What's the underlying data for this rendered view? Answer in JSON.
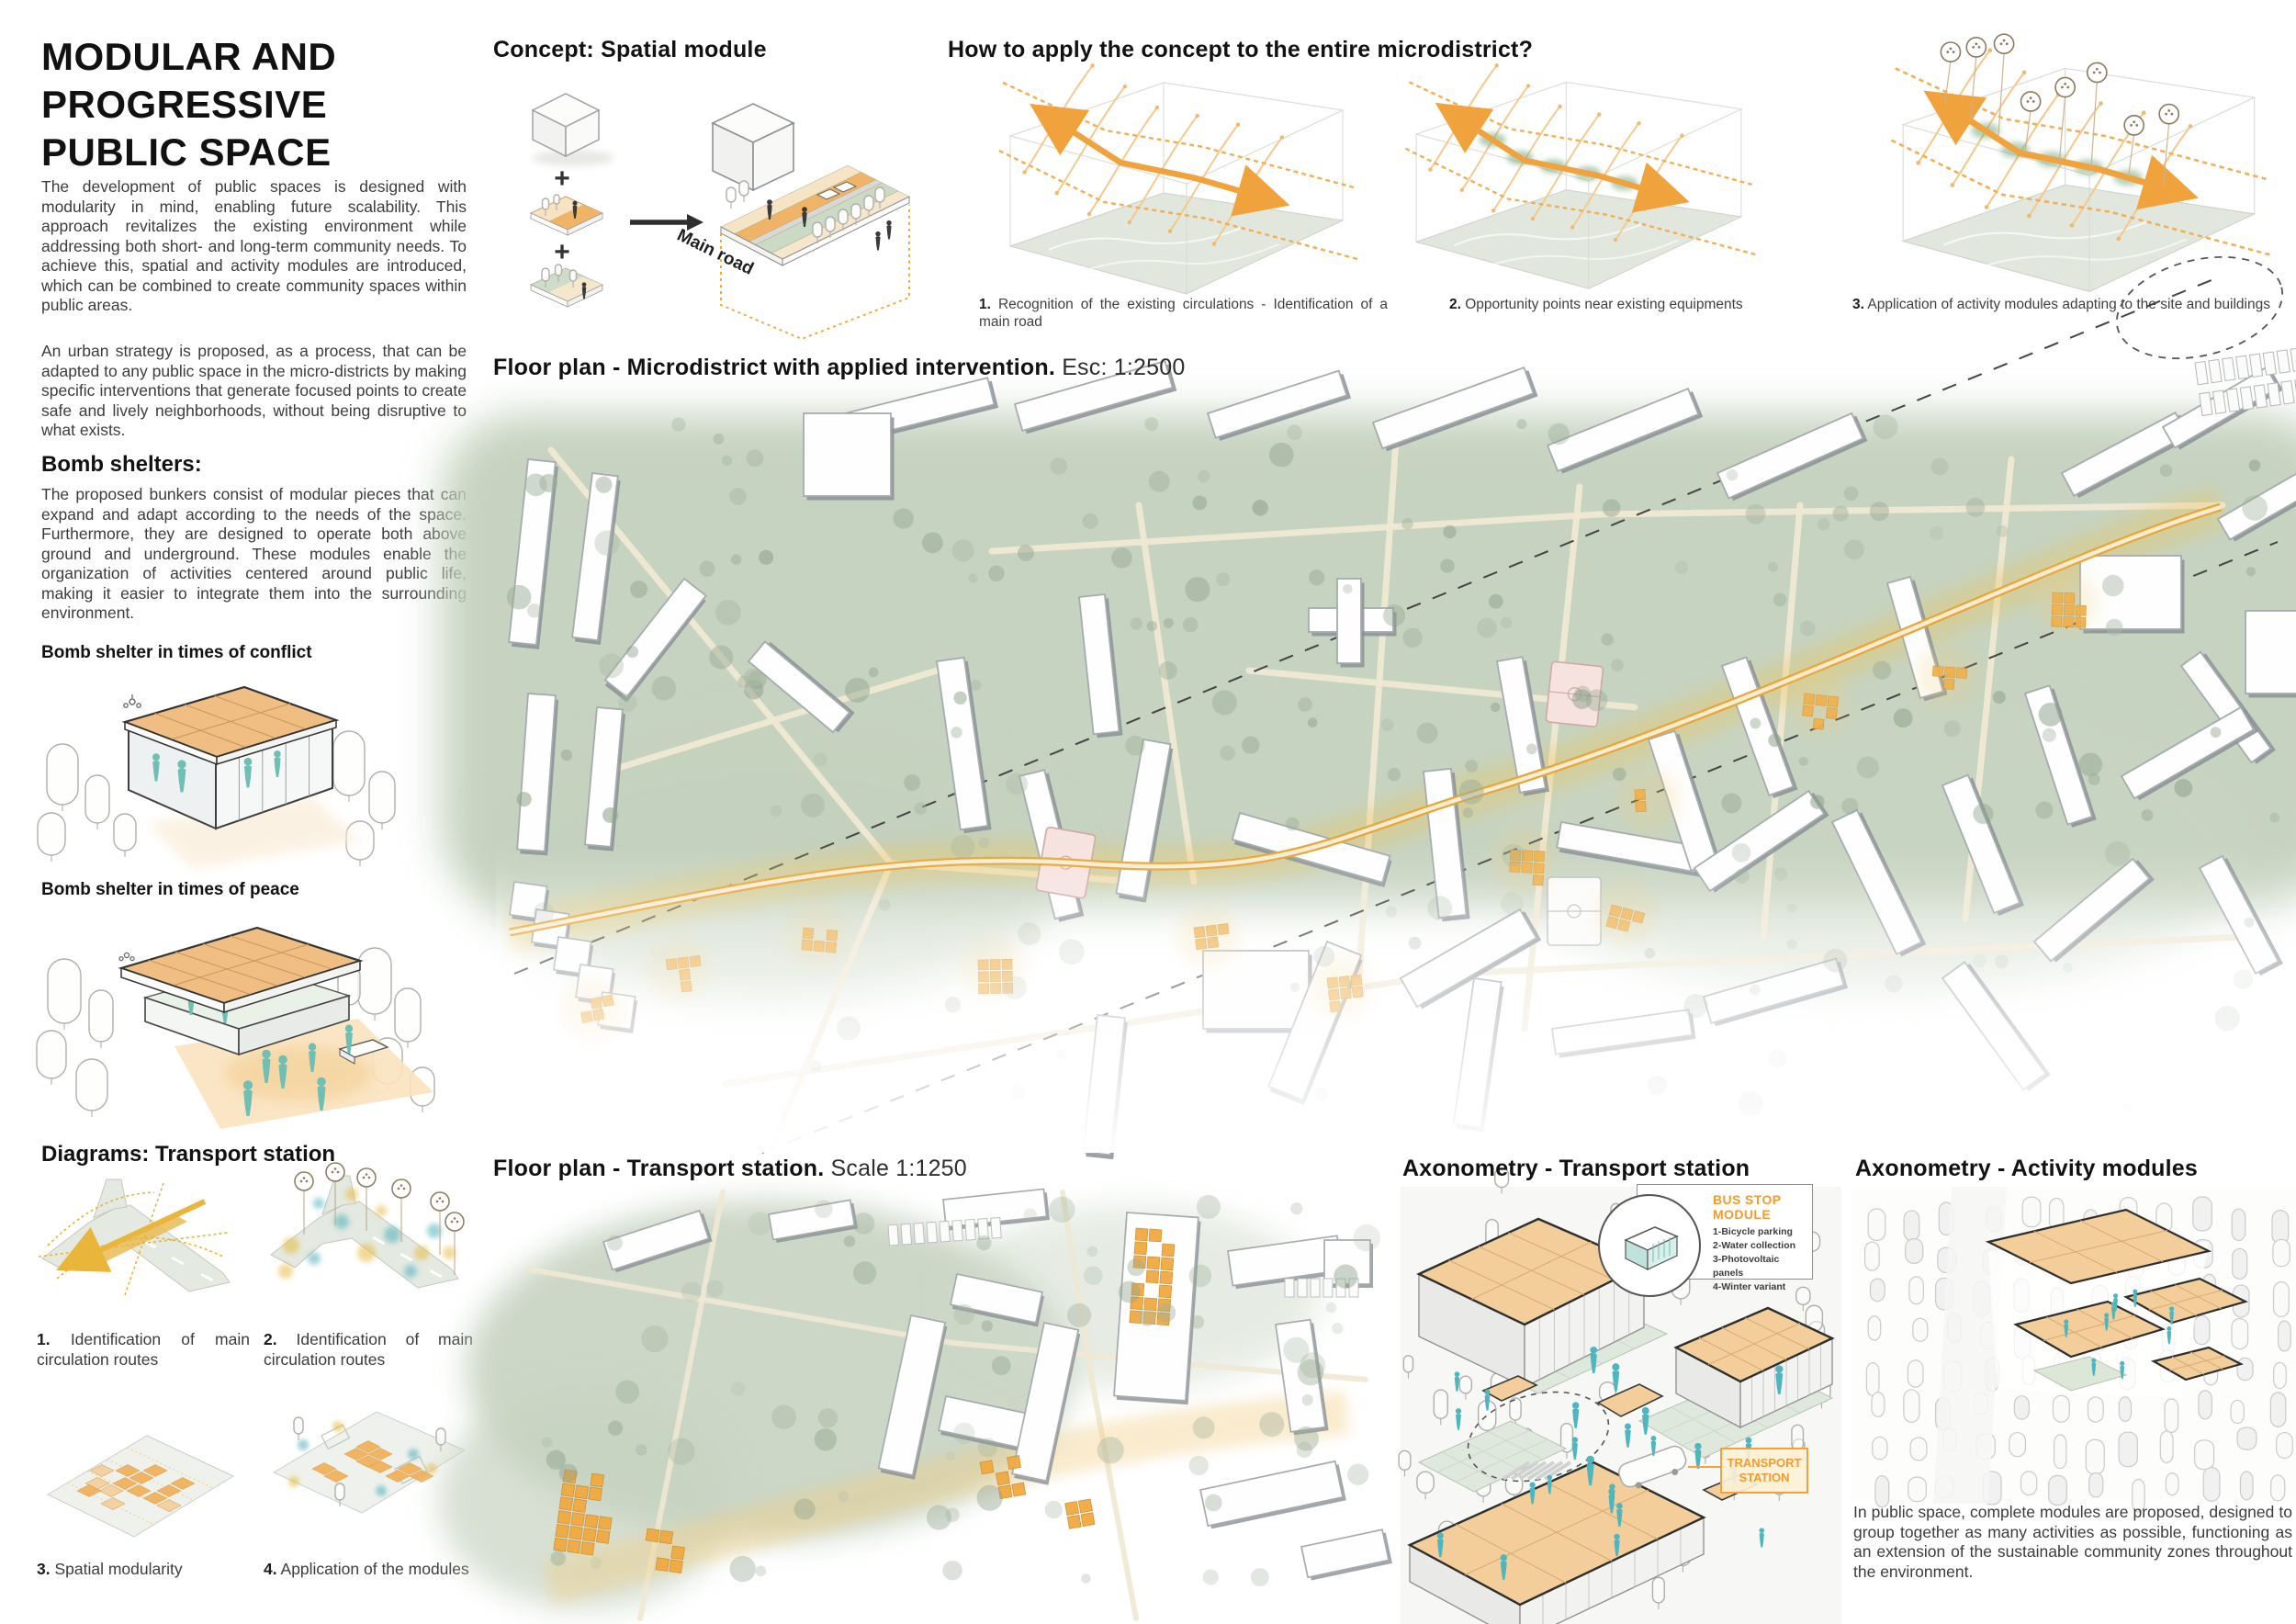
{
  "left": {
    "title_lines": [
      "MODULAR AND",
      "PROGRESSIVE",
      "PUBLIC SPACE"
    ],
    "intro1": "The development of public spaces is designed with modularity in mind, enabling future scalability. This approach revitalizes the existing environment while addressing both short- and long-term community needs. To achieve this, spatial and activity modules are introduced, which can be combined to create community spaces within public areas.",
    "intro2": "An urban strategy is proposed, as a process, that can be adapted to any public space in the micro-districts by making specific interventions that generate focused points to create safe and lively neighborhoods, without being disruptive to what exists.",
    "bomb_heading": "Bomb shelters:",
    "bomb_body": "The proposed bunkers consist of modular pieces that can expand and adapt according to the needs of the space. Furthermore, they are designed to operate both above ground and underground. These modules enable the organization of activities centered around public life, making it easier to integrate them into the surrounding environment.",
    "conflict_label": "Bomb shelter in times of conflict",
    "peace_label": "Bomb shelter in times of peace",
    "diagrams_heading": "Diagrams: Transport station",
    "captions": [
      {
        "num": "1.",
        "text": "Identification of main circulation routes"
      },
      {
        "num": "2.",
        "text": "Identification of main circulation routes"
      },
      {
        "num": "3.",
        "text": "Spatial modularity"
      },
      {
        "num": "4.",
        "text": "Application of the modules"
      }
    ]
  },
  "concept": {
    "heading": "Concept: Spatial module",
    "main_road": "Main road",
    "plus": "+"
  },
  "apply": {
    "heading": "How to apply the concept to the entire microdistrict?",
    "steps": [
      {
        "num": "1.",
        "text": "Recognition of the existing circulations - Identification of a main road"
      },
      {
        "num": "2.",
        "text": "Opportunity points near existing equipments"
      },
      {
        "num": "3.",
        "text": "Application of activity modules adapting to the site and buildings"
      }
    ]
  },
  "plan_micro": {
    "title": "Floor plan - Microdistrict with applied intervention.",
    "scale": "Esc: 1:2500"
  },
  "plan_station": {
    "title": "Floor plan - Transport station.",
    "scale": "Scale 1:1250"
  },
  "axon_station": {
    "heading": "Axonometry - Transport station",
    "bus_stop": {
      "title": "BUS STOP MODULE",
      "items": [
        "1-Bicycle parking",
        "2-Water collection",
        "3-Photovoltaic panels",
        "4-Winter variant"
      ]
    },
    "station_label": "TRANSPORT STATION"
  },
  "axon_modules": {
    "heading": "Axonometry - Activity modules",
    "body": "In public space, complete modules are proposed, designed to group together  as many activities as possible, functioning as an extension of the sustainable community zones throughout the environment."
  },
  "colors": {
    "accent_orange": "#F0A23C",
    "roof_orange": "#F3CD9A",
    "module_orange": "#F0A940",
    "glow_yellow": "#EFC455",
    "teal_figure": "#6FBFB4",
    "dot_teal": "#4FB0BC",
    "dot_yellow": "#E7BA3C",
    "plan_green": "#C4D1BD",
    "label_orange": "#F39C2D"
  }
}
